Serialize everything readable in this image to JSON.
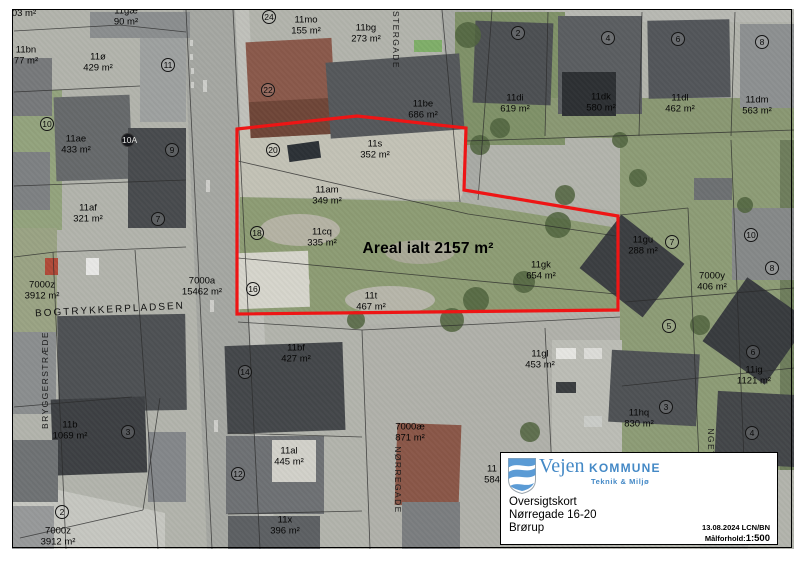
{
  "colors": {
    "boundary_red": "#ee1515",
    "logo_blue": "#4489c6"
  },
  "map": {
    "highlight": {
      "label": "Areal ialt 2157 m²",
      "x": 428,
      "y": 249,
      "points": "237,129 357,116 466,128 464,190 618,216 618,310 237,314",
      "color": "#ee1515"
    },
    "streets": [
      {
        "name": "ØSTERGADE",
        "x": 396,
        "y": 36,
        "rot": 90,
        "cls": ""
      },
      {
        "name": "BOGTRYKKERPLADSEN",
        "x": 110,
        "y": 310,
        "rot": -3,
        "cls": "place"
      },
      {
        "name": "BRYGGERSTRÆDE",
        "x": 45,
        "y": 380,
        "rot": -90,
        "cls": ""
      },
      {
        "name": "NØRREGADE",
        "x": 398,
        "y": 480,
        "rot": 90,
        "cls": ""
      },
      {
        "name": "NGET",
        "x": 711,
        "y": 443,
        "rot": 90,
        "cls": ""
      }
    ],
    "parcels": [
      {
        "id": "",
        "area": "03 m²",
        "x": 24,
        "y": 14
      },
      {
        "id": "11gæ",
        "area": "90 m²",
        "x": 126,
        "y": 17
      },
      {
        "id": "11bn",
        "area": "77 m²",
        "x": 26,
        "y": 56
      },
      {
        "id": "11ø",
        "area": "429 m²",
        "x": 98,
        "y": 63
      },
      {
        "id": "11mo",
        "area": "155 m²",
        "x": 306,
        "y": 26
      },
      {
        "id": "11bg",
        "area": "273 m²",
        "x": 366,
        "y": 34
      },
      {
        "id": "11be",
        "area": "686 m²",
        "x": 423,
        "y": 110
      },
      {
        "id": "11di",
        "area": "619 m²",
        "x": 515,
        "y": 104
      },
      {
        "id": "11dk",
        "area": "580 m²",
        "x": 601,
        "y": 103
      },
      {
        "id": "11dl",
        "area": "462 m²",
        "x": 680,
        "y": 104
      },
      {
        "id": "11dm",
        "area": "563 m²",
        "x": 757,
        "y": 106
      },
      {
        "id": "11ae",
        "area": "433 m²",
        "x": 76,
        "y": 145
      },
      {
        "id": "11af",
        "area": "321 m²",
        "x": 88,
        "y": 214
      },
      {
        "id": "7000z",
        "area": "3912 m²",
        "x": 42,
        "y": 291
      },
      {
        "id": "7000a",
        "area": "15462 m²",
        "x": 202,
        "y": 287
      },
      {
        "id": "11s",
        "area": "352 m²",
        "x": 375,
        "y": 150
      },
      {
        "id": "11am",
        "area": "349 m²",
        "x": 327,
        "y": 196
      },
      {
        "id": "11cq",
        "area": "335 m²",
        "x": 322,
        "y": 238
      },
      {
        "id": "11t",
        "area": "467 m²",
        "x": 371,
        "y": 302
      },
      {
        "id": "11gk",
        "area": "654 m²",
        "x": 541,
        "y": 271
      },
      {
        "id": "11gu",
        "area": "288 m²",
        "x": 643,
        "y": 246
      },
      {
        "id": "7000y",
        "area": "406 m²",
        "x": 712,
        "y": 282
      },
      {
        "id": "11gl",
        "area": "453 m²",
        "x": 540,
        "y": 360
      },
      {
        "id": "11ig",
        "area": "1121 m²",
        "x": 754,
        "y": 376
      },
      {
        "id": "11hq",
        "area": "830 m²",
        "x": 639,
        "y": 419
      },
      {
        "id": "11bf",
        "area": "427 m²",
        "x": 296,
        "y": 354
      },
      {
        "id": "11al",
        "area": "445 m²",
        "x": 289,
        "y": 457
      },
      {
        "id": "7000æ",
        "area": "871 m²",
        "x": 410,
        "y": 433
      },
      {
        "id": "11x",
        "area": "396 m²",
        "x": 285,
        "y": 526
      },
      {
        "id": "11b",
        "area": "1069 m²",
        "x": 70,
        "y": 431
      },
      {
        "id": "7000z",
        "area": "3912 m²",
        "x": 58,
        "y": 537
      },
      {
        "id": "11",
        "area": "584",
        "x": 492,
        "y": 475
      }
    ],
    "house_numbers": [
      {
        "n": "11",
        "x": 168,
        "y": 65
      },
      {
        "n": "24",
        "x": 269,
        "y": 17
      },
      {
        "n": "22",
        "x": 268,
        "y": 90
      },
      {
        "n": "10",
        "x": 47,
        "y": 124
      },
      {
        "n": "10A",
        "x": 128,
        "y": 140,
        "filled": true
      },
      {
        "n": "9",
        "x": 172,
        "y": 150
      },
      {
        "n": "7",
        "x": 158,
        "y": 219
      },
      {
        "n": "20",
        "x": 273,
        "y": 150
      },
      {
        "n": "18",
        "x": 257,
        "y": 233
      },
      {
        "n": "16",
        "x": 253,
        "y": 289
      },
      {
        "n": "14",
        "x": 245,
        "y": 372
      },
      {
        "n": "12",
        "x": 238,
        "y": 474
      },
      {
        "n": "2",
        "x": 518,
        "y": 33
      },
      {
        "n": "4",
        "x": 608,
        "y": 38
      },
      {
        "n": "6",
        "x": 678,
        "y": 39
      },
      {
        "n": "8",
        "x": 762,
        "y": 42
      },
      {
        "n": "7",
        "x": 672,
        "y": 242
      },
      {
        "n": "10",
        "x": 751,
        "y": 235
      },
      {
        "n": "8",
        "x": 772,
        "y": 268
      },
      {
        "n": "5",
        "x": 669,
        "y": 326
      },
      {
        "n": "6",
        "x": 753,
        "y": 352
      },
      {
        "n": "3",
        "x": 666,
        "y": 407
      },
      {
        "n": "4",
        "x": 752,
        "y": 433
      },
      {
        "n": "3",
        "x": 128,
        "y": 432
      },
      {
        "n": "2",
        "x": 62,
        "y": 512
      }
    ]
  },
  "info_box": {
    "logo_word1": "Vejen",
    "logo_word2": "KOMMUNE",
    "logo_sub": "Teknik & Miljø",
    "title": "Oversigtskort",
    "address": "Nørregade 16-20",
    "city": "Brørup",
    "date": "13.08.2024 LCN/BN",
    "scale_label": "Målforhold:",
    "scale_value": "1:500"
  }
}
